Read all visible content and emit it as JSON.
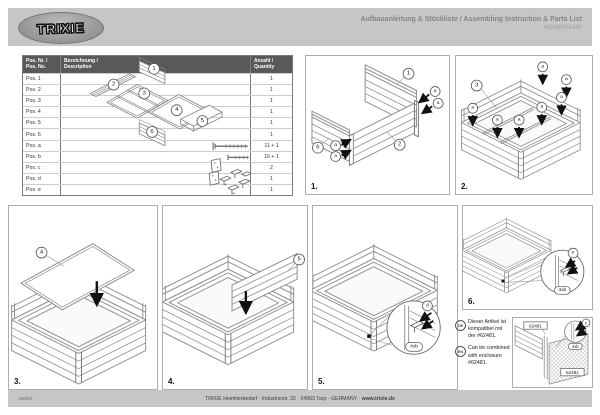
{
  "header": {
    "logo_text": "TRIXIE",
    "title": "Aufbauanleitung & Stückliste / Assembling Instruction & Parts List",
    "product_numbers": "#62485/62486"
  },
  "parts_table": {
    "columns": {
      "pos_l1": "Pos. Nr. /",
      "pos_l2": "Pos. No.",
      "desc_l1": "Bezeichnung /",
      "desc_l2": "Description",
      "qty_l1": "Anzahl /",
      "qty_l2": "Quantity"
    },
    "rows": [
      {
        "pos": "Pos. 1",
        "qty": "1"
      },
      {
        "pos": "Pos. 2",
        "qty": "1"
      },
      {
        "pos": "Pos. 3",
        "qty": "1"
      },
      {
        "pos": "Pos. 4",
        "qty": "1"
      },
      {
        "pos": "Pos. 5",
        "qty": "1"
      },
      {
        "pos": "Pos. 6",
        "qty": "1"
      },
      {
        "pos": "Pos. a",
        "qty": "11 + 1"
      },
      {
        "pos": "Pos. b",
        "qty": "16 + 1"
      },
      {
        "pos": "Pos. c",
        "qty": "2"
      },
      {
        "pos": "Pos. d",
        "qty": "1"
      },
      {
        "pos": "Pos. e",
        "qty": "1"
      }
    ],
    "diagram": {
      "p1": "1",
      "p2": "2",
      "p3": "3",
      "p4": "4",
      "p5": "5",
      "p6": "6"
    }
  },
  "steps": [
    {
      "label": "1.",
      "n1": "1",
      "n2": "2",
      "n6": "6",
      "screw": "a"
    },
    {
      "label": "2.",
      "n3": "3",
      "screw": "a"
    },
    {
      "label": "3.",
      "n4": "4"
    },
    {
      "label": "4.",
      "n5": "5"
    },
    {
      "label": "5.",
      "fitting": "d",
      "screws": "4xb"
    },
    {
      "label": "6.",
      "fitting": "e",
      "screws": "4xb"
    }
  ],
  "note": {
    "de_badge": "DE",
    "de_text": "Dieser Artikel ist kompatibel mit der #62481.",
    "en_badge": "EN",
    "en_text": "Can be combined with enclosure #62481.",
    "enclosure_label_1": "62481",
    "enclosure_label_2": "62481",
    "fitting": "c",
    "screws": "4xb"
  },
  "footer": {
    "code": "190521",
    "address": "TRIXIE Heimtierbedarf · Industriestr. 32 · 24963 Tarp · GERMANY · ",
    "website": "www.trixie.de"
  }
}
